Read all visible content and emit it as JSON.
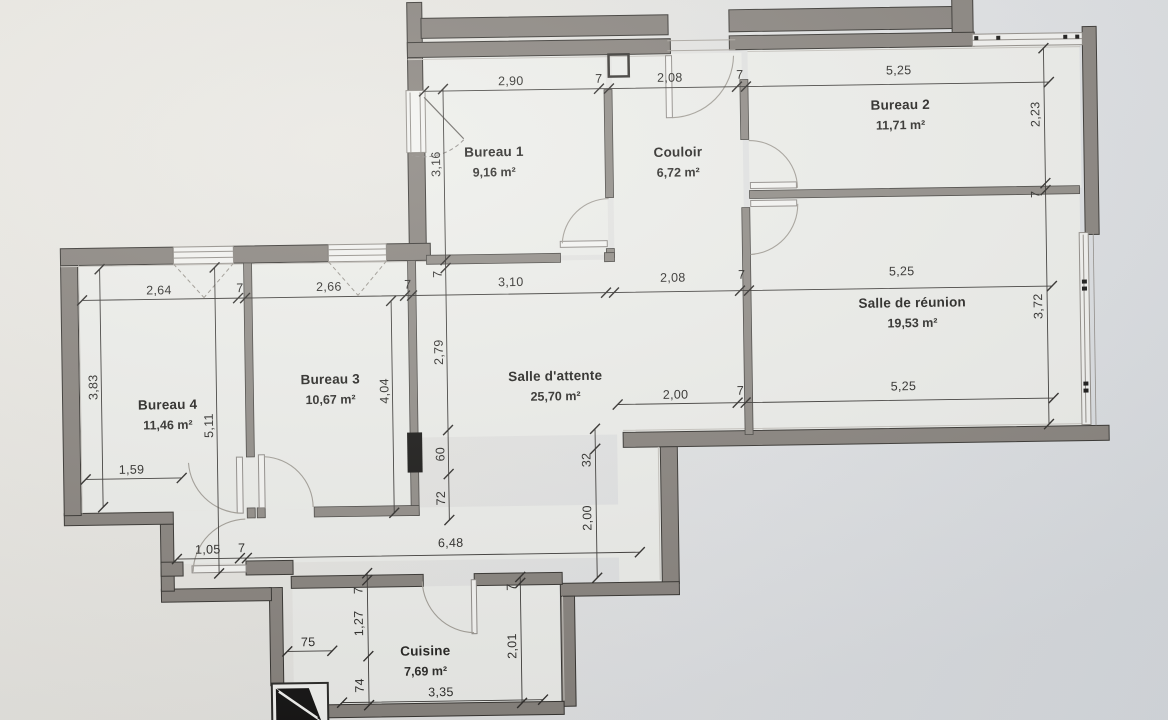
{
  "plan": {
    "colors": {
      "wall_exterior": "#87827c",
      "wall_outline": "#34322e",
      "wall_interior": "#908c86",
      "paper_warm": "#ebe9e3",
      "paper_cool": "#d8dce0",
      "floor": "#edeeea",
      "ink": "#2b2a27",
      "shaft_black": "#141312"
    },
    "rooms": [
      {
        "name": "Bureau 1",
        "area": "9,16 m²",
        "x": 497,
        "y": 155
      },
      {
        "name": "Couloir",
        "area": "6,72 m²",
        "x": 681,
        "y": 158
      },
      {
        "name": "Bureau 2",
        "area": "11,71 m²",
        "x": 904,
        "y": 114
      },
      {
        "name": "Salle de réunion",
        "area": "19,53 m²",
        "x": 913,
        "y": 312
      },
      {
        "name": "Bureau 4",
        "area": "11,46 m²",
        "x": 167,
        "y": 403
      },
      {
        "name": "Bureau 3",
        "area": "10,67 m²",
        "x": 330,
        "y": 380
      },
      {
        "name": "Salle d'attente",
        "area": "25,70 m²",
        "x": 555,
        "y": 380
      },
      {
        "name": "Cuisine",
        "area": "7,69 m²",
        "x": 421,
        "y": 653
      }
    ],
    "dims": [
      {
        "t": "2,90",
        "x": 515,
        "y": 84,
        "o": "h"
      },
      {
        "t": "7",
        "x": 603,
        "y": 83,
        "o": "h"
      },
      {
        "t": "2,08",
        "x": 674,
        "y": 83,
        "o": "h"
      },
      {
        "t": "7",
        "x": 744,
        "y": 81,
        "o": "h"
      },
      {
        "t": "5,25",
        "x": 903,
        "y": 79,
        "o": "h"
      },
      {
        "t": "2,64",
        "x": 160,
        "y": 288,
        "o": "h"
      },
      {
        "t": "7",
        "x": 241,
        "y": 287,
        "o": "h"
      },
      {
        "t": "2,66",
        "x": 330,
        "y": 287,
        "o": "h"
      },
      {
        "t": "7",
        "x": 409,
        "y": 286,
        "o": "h"
      },
      {
        "t": "3,10",
        "x": 512,
        "y": 285,
        "o": "h"
      },
      {
        "t": "2,08",
        "x": 674,
        "y": 283,
        "o": "h"
      },
      {
        "t": "7",
        "x": 743,
        "y": 281,
        "o": "h"
      },
      {
        "t": "5,25",
        "x": 903,
        "y": 280,
        "o": "h"
      },
      {
        "t": "2,00",
        "x": 675,
        "y": 400,
        "o": "h"
      },
      {
        "t": "7",
        "x": 740,
        "y": 397,
        "o": "h"
      },
      {
        "t": "5,25",
        "x": 903,
        "y": 395,
        "o": "h"
      },
      {
        "t": "1,59",
        "x": 130,
        "y": 467,
        "o": "h"
      },
      {
        "t": "1,05",
        "x": 205,
        "y": 548,
        "o": "h"
      },
      {
        "t": "7",
        "x": 239,
        "y": 547,
        "o": "h"
      },
      {
        "t": "6,48",
        "x": 448,
        "y": 545,
        "o": "h"
      },
      {
        "t": "75",
        "x": 304,
        "y": 642,
        "o": "h"
      },
      {
        "t": "3,35",
        "x": 436,
        "y": 694,
        "o": "h"
      },
      {
        "t": "3,16",
        "x": 443,
        "y": 162,
        "o": "v"
      },
      {
        "t": "7",
        "x": 443,
        "y": 272,
        "o": "v"
      },
      {
        "t": "2,79",
        "x": 443,
        "y": 350,
        "o": "v"
      },
      {
        "t": "60",
        "x": 443,
        "y": 452,
        "o": "v"
      },
      {
        "t": "72",
        "x": 443,
        "y": 496,
        "o": "v"
      },
      {
        "t": "4,04",
        "x": 388,
        "y": 388,
        "o": "v"
      },
      {
        "t": "3,83",
        "x": 97,
        "y": 380,
        "o": "v"
      },
      {
        "t": "5,11",
        "x": 212,
        "y": 420,
        "o": "v"
      },
      {
        "t": "32",
        "x": 589,
        "y": 460,
        "o": "v"
      },
      {
        "t": "2,00",
        "x": 589,
        "y": 518,
        "o": "v"
      },
      {
        "t": "7",
        "x": 359,
        "y": 587,
        "o": "v"
      },
      {
        "t": "1,27",
        "x": 359,
        "y": 620,
        "o": "v"
      },
      {
        "t": "74",
        "x": 359,
        "y": 682,
        "o": "v"
      },
      {
        "t": "7",
        "x": 512,
        "y": 586,
        "o": "v"
      },
      {
        "t": "2,01",
        "x": 512,
        "y": 645,
        "o": "v"
      },
      {
        "t": "2,23",
        "x": 1043,
        "y": 121,
        "o": "v"
      },
      {
        "t": "7",
        "x": 1042,
        "y": 201,
        "o": "v"
      },
      {
        "t": "3,72",
        "x": 1043,
        "y": 313,
        "o": "v"
      }
    ]
  }
}
